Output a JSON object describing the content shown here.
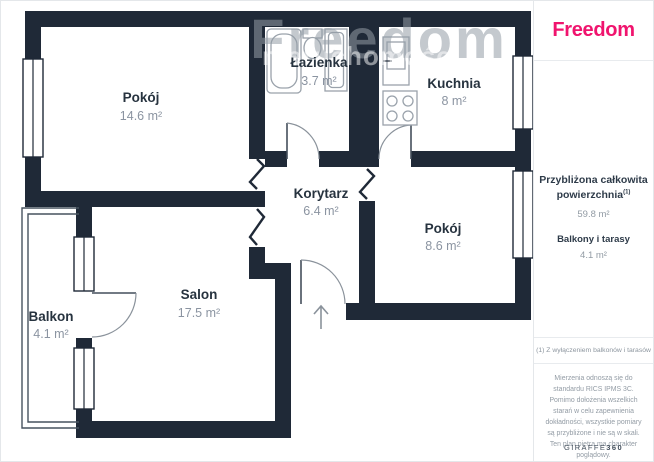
{
  "floor_plan": {
    "watermark": "Freedom",
    "watermark_secondary": "nieruchomości",
    "rooms": [
      {
        "name": "Pokój",
        "area": "14.6 m²"
      },
      {
        "name": "Łazienka",
        "area": "3.7 m²"
      },
      {
        "name": "Kuchnia",
        "area": "8 m²"
      },
      {
        "name": "Korytarz",
        "area": "6.4 m²"
      },
      {
        "name": "Pokój",
        "area": "8.6 m²"
      },
      {
        "name": "Salon",
        "area": "17.5 m²"
      },
      {
        "name": "Balkon",
        "area": "4.1 m²"
      }
    ],
    "wall_color": "#1f2937"
  },
  "sidebar": {
    "logo": "Freedom",
    "brand_color": "#f0146e",
    "summary_title_line1": "Przybliżona całkowita",
    "summary_title_line2": "powierzchnia",
    "summary_sup": "(1)",
    "summary_value": "59.8 m²",
    "balcony_label": "Balkony i tarasy",
    "balcony_value": "4.1 m²",
    "footnote": "(1) Z wyłączeniem balkonów i tarasów",
    "disclaimer": "Mierzenia odnoszą się do standardu RICS IPMS 3C. Pomimo dołożenia wszelkich starań w celu zapewnienia dokładności, wszystkie pomiary są przybliżone i nie są w skali. Ten plan piętra ma charakter poglądowy.",
    "brand_footer": "GIRAFFE",
    "brand_footer_bold": "360"
  }
}
